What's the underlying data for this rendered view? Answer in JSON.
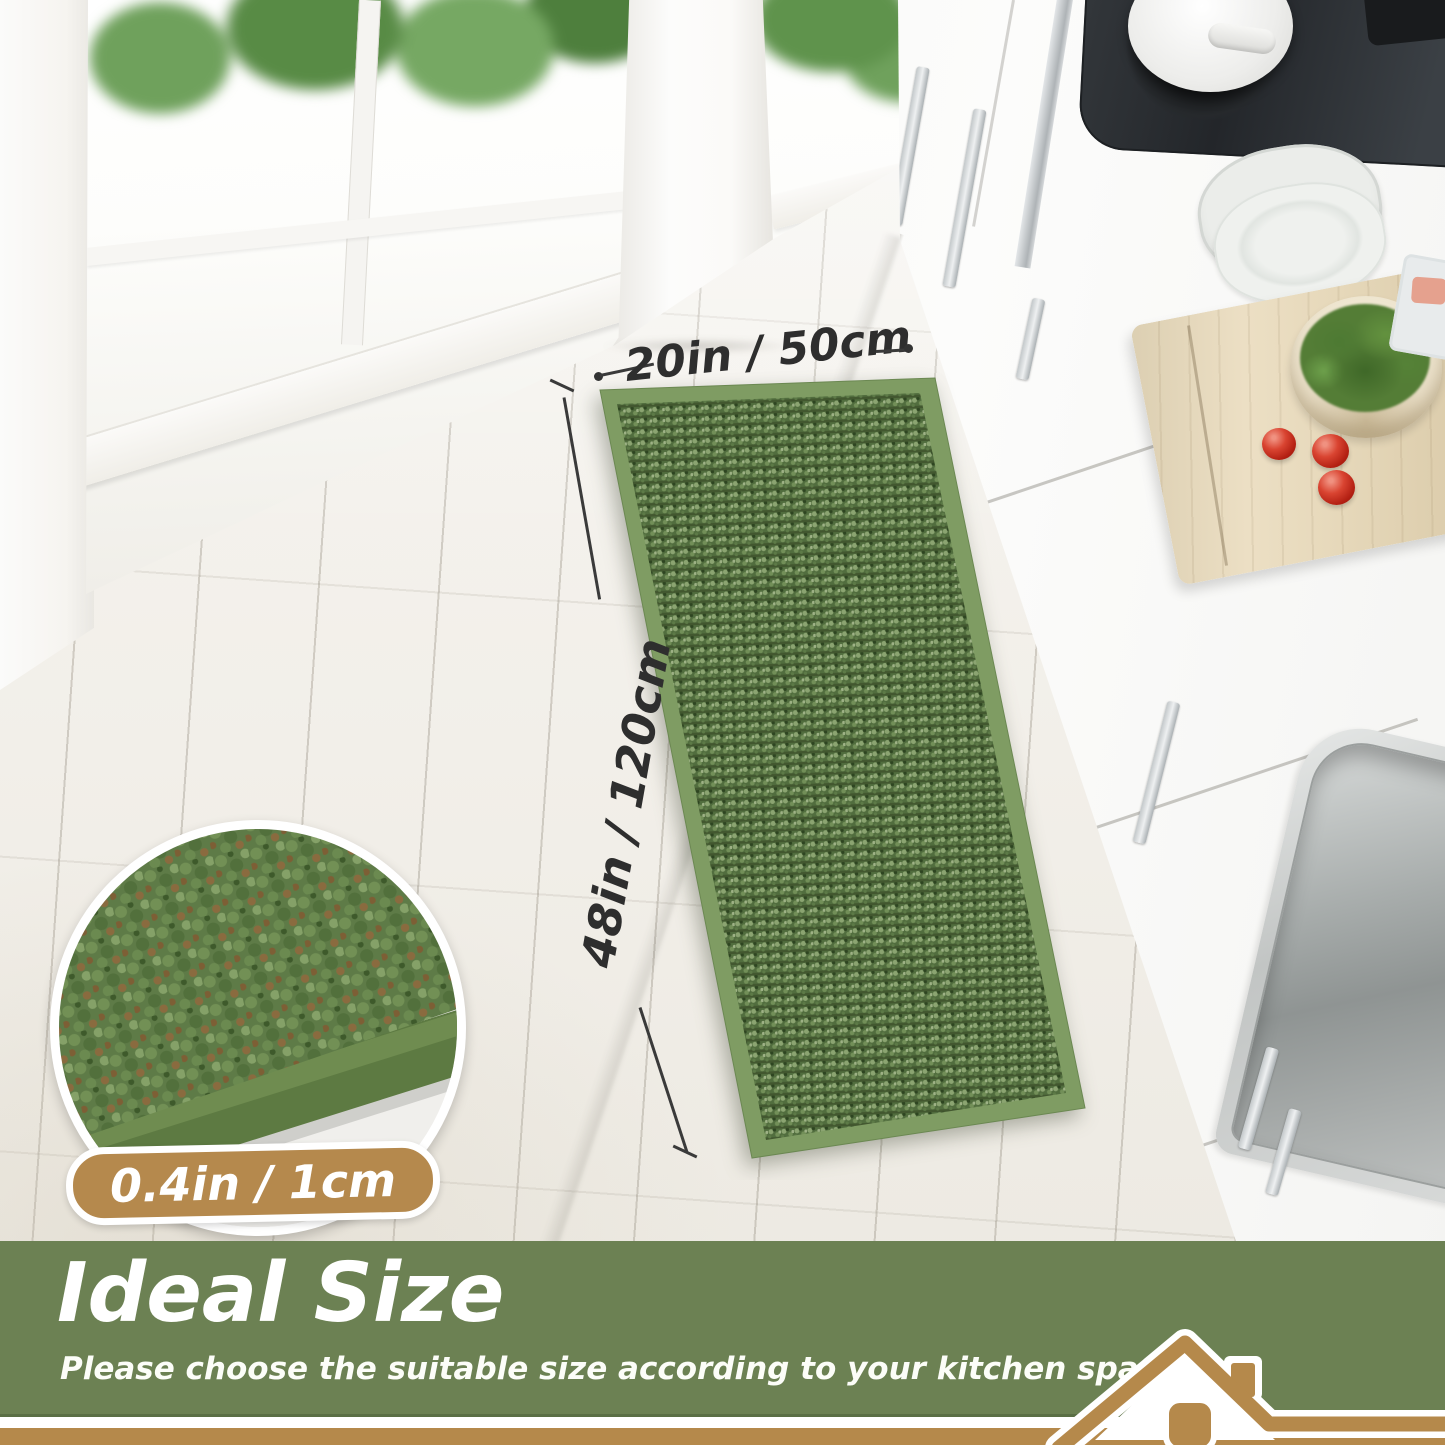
{
  "annotations": {
    "width_label": "20in / 50cm",
    "length_label": "48in / 120cm",
    "thickness_label": "0.4in / 1cm"
  },
  "banner": {
    "title": "Ideal Size",
    "subtitle": "Please choose the suitable size according to your kitchen space"
  },
  "colors": {
    "banner_green": "#6c8153",
    "banner_green_dark": "#5a6f45",
    "accent_gold": "#b5894b",
    "rug_border_green": "#7f9c63",
    "rug_field_green": "#516d3e",
    "annotation_text": "#2e2e2e",
    "text_white": "#ffffff"
  }
}
